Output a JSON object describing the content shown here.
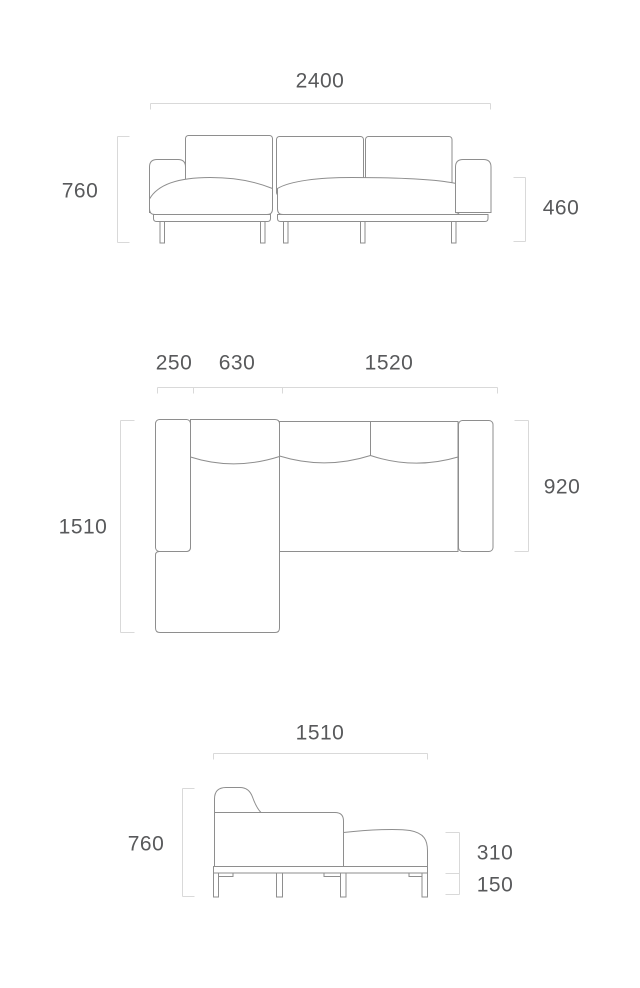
{
  "colors": {
    "outline": "#8e8e8e",
    "dimension_line": "#d9d9d9",
    "text": "#58595b",
    "background": "#ffffff"
  },
  "views": {
    "front_elevation": {
      "dims": {
        "overall_width": "2400",
        "overall_height": "760",
        "arm_height": "460"
      }
    },
    "top_plan": {
      "dims": {
        "arm_width": "250",
        "chaise_width": "630",
        "seat_width": "1520",
        "overall_depth": "1510",
        "body_depth": "920"
      }
    },
    "side_elevation": {
      "dims": {
        "overall_depth": "1510",
        "overall_height": "760",
        "seat_section_height": "310",
        "base_height": "150"
      }
    }
  }
}
